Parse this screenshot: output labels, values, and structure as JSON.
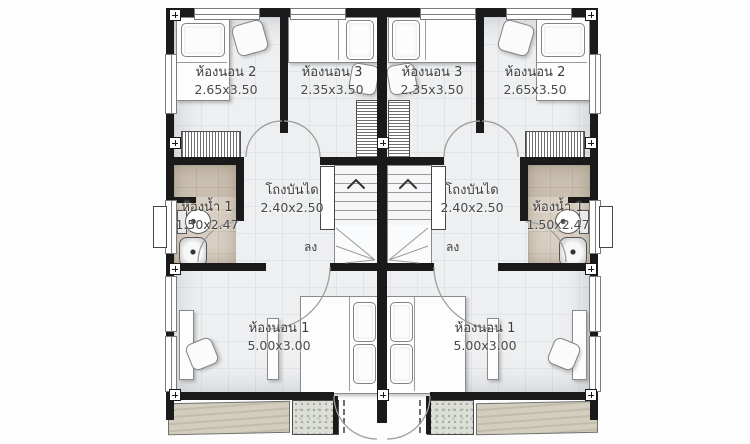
{
  "floorplan": {
    "type": "twin-house second floor plan",
    "units": {
      "left": {
        "bedroom2": {
          "name": "ห้องนอน 2",
          "size": "2.65x3.50"
        },
        "bedroom3": {
          "name": "ห้องนอน 3",
          "size": "2.35x3.50"
        },
        "bathroom": {
          "name": "ห้องน้ำ 1",
          "size": "1.50x2.47"
        },
        "stair_hall": {
          "name": "โถงบันได",
          "size": "2.40x2.50"
        },
        "bedroom1": {
          "name": "ห้องนอน 1",
          "size": "5.00x3.00"
        },
        "stair_down": "ลง"
      },
      "right": {
        "bedroom2": {
          "name": "ห้องนอน 2",
          "size": "2.65x3.50"
        },
        "bedroom3": {
          "name": "ห้องนอน 3",
          "size": "2.35x3.50"
        },
        "bathroom": {
          "name": "ห้องน้ำ 1",
          "size": "1.50x2.47"
        },
        "stair_hall": {
          "name": "โถงบันได",
          "size": "2.40x2.50"
        },
        "bedroom1": {
          "name": "ห้องนอน 1",
          "size": "5.00x3.00"
        },
        "stair_down": "ลง"
      }
    },
    "colors": {
      "wall": "#1a1a1a",
      "floor": "#edeff1",
      "floor_grid": "#e0e4e6",
      "bathroom_floor": "#d8cfc2",
      "balcony_awning": "#cbc4b3",
      "balcony_concrete": "#dcdfd8"
    }
  }
}
